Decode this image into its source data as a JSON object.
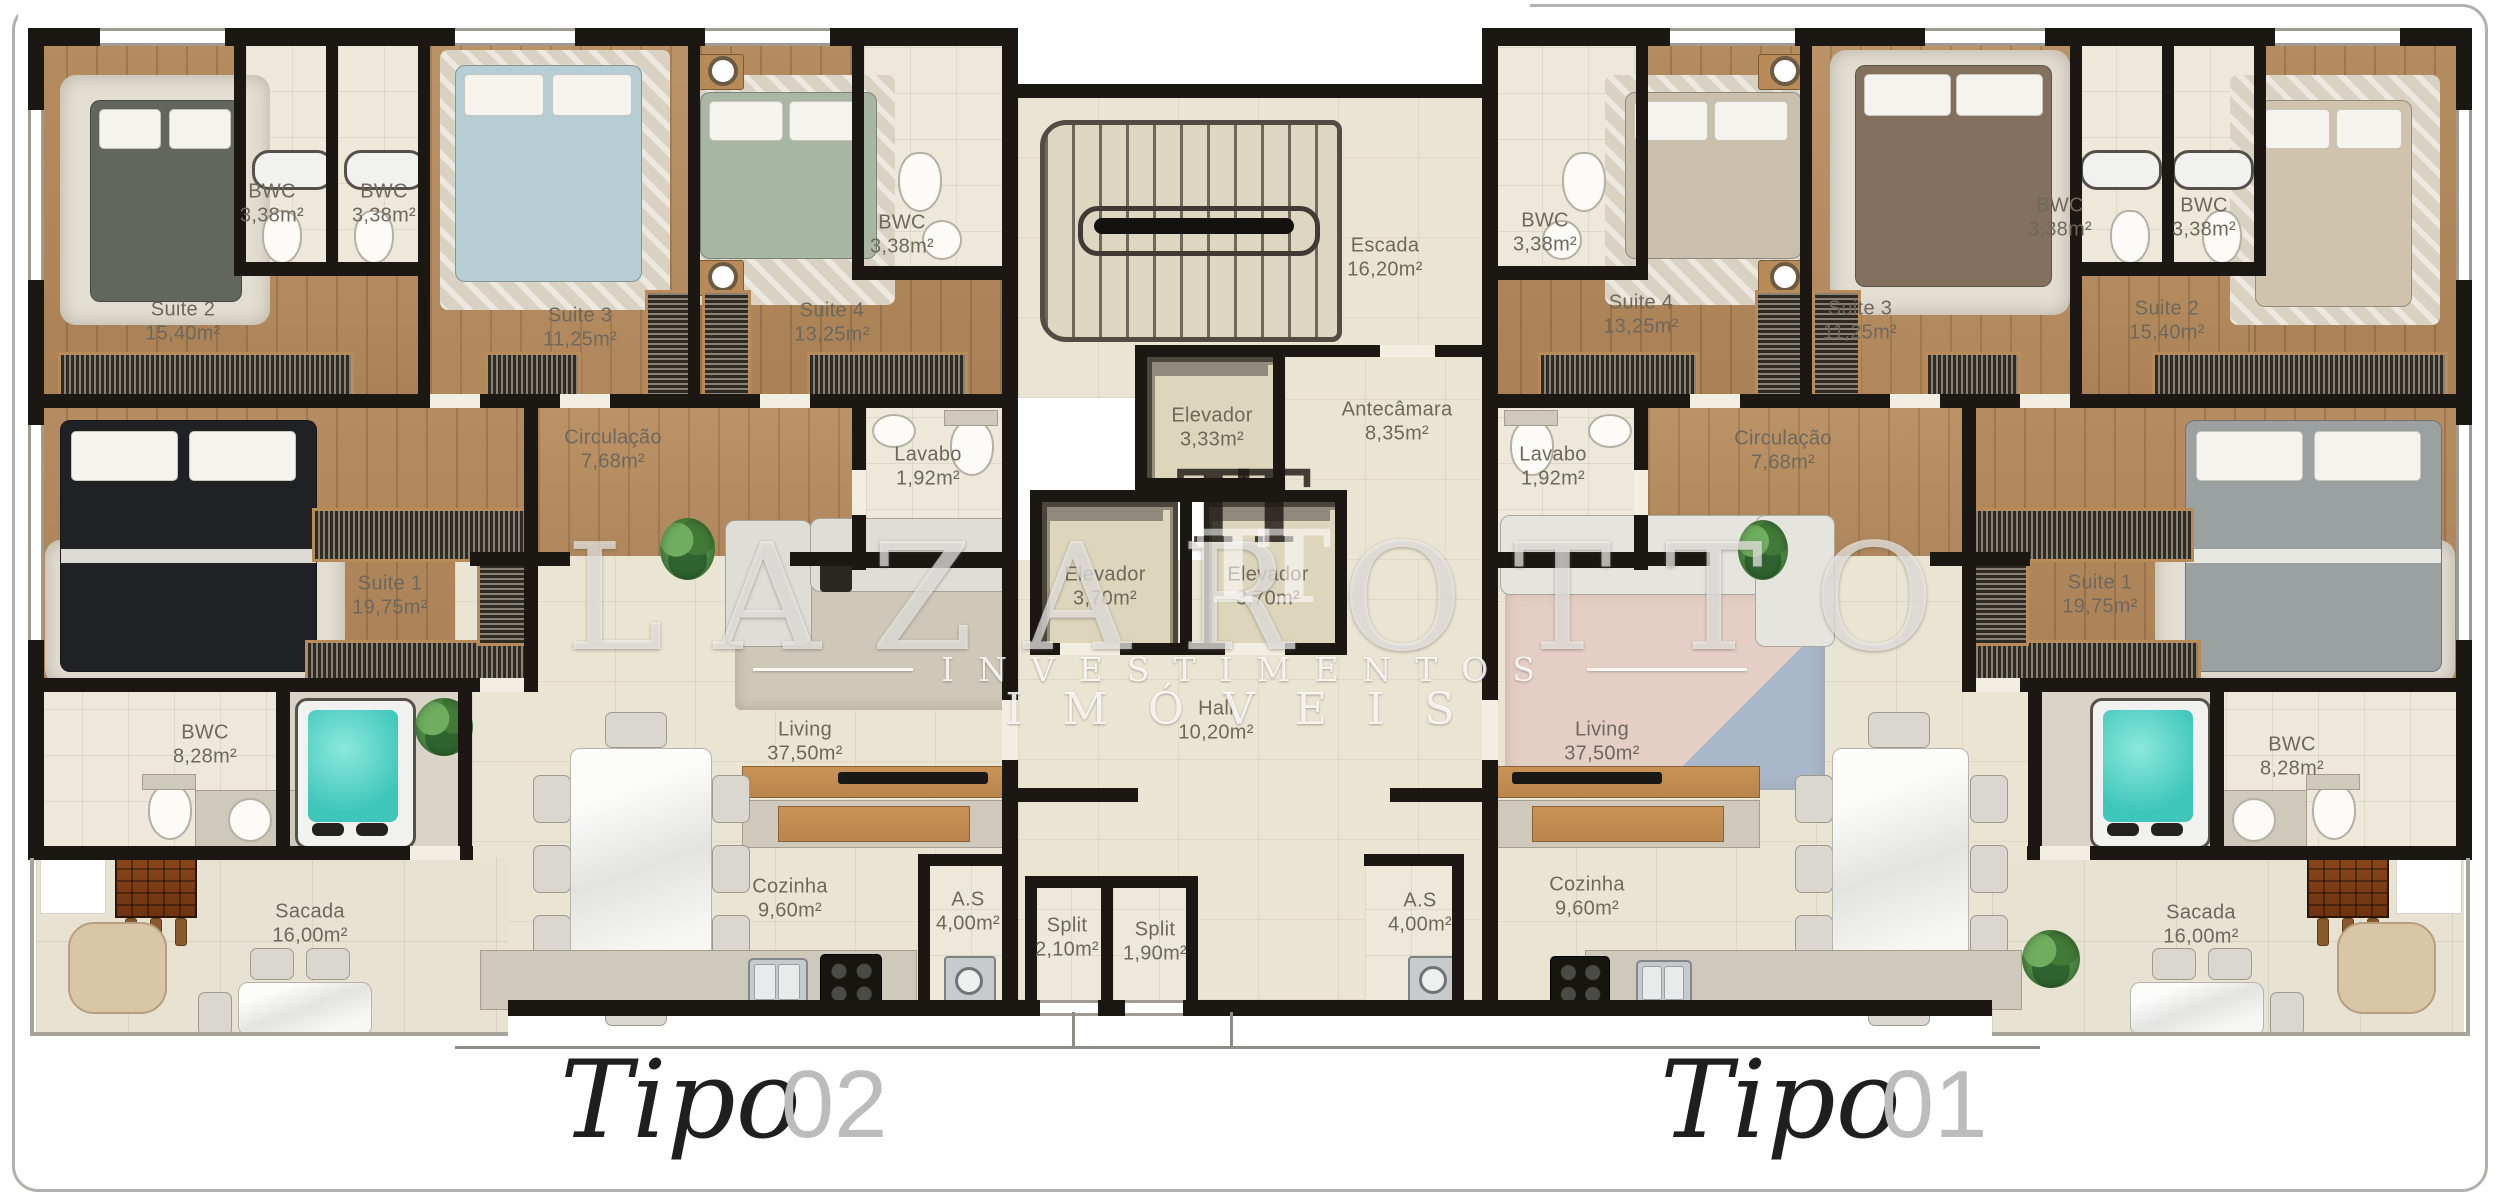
{
  "watermark": {
    "monogram": "TT",
    "brand": "LAZAROTTO",
    "line1": "INVESTIMENTOS",
    "line2": "IMÓVEIS"
  },
  "units": {
    "left": {
      "script": "Tipo",
      "number": "02"
    },
    "right": {
      "script": "Tipo",
      "number": "01"
    }
  },
  "rooms": {
    "l_suite2": {
      "name": "Suite 2",
      "area": "15,40m²"
    },
    "l_bwc_a": {
      "name": "BWC",
      "area": "3,38m²"
    },
    "l_bwc_b": {
      "name": "BWC",
      "area": "3,38m²"
    },
    "l_suite3": {
      "name": "Suite 3",
      "area": "11,25m²"
    },
    "l_suite4": {
      "name": "Suite 4",
      "area": "13,25m²"
    },
    "l_bwc_s4": {
      "name": "BWC",
      "area": "3,38m²"
    },
    "l_suite1": {
      "name": "Suite 1",
      "area": "19,75m²"
    },
    "l_circulacao": {
      "name": "Circulação",
      "area": "7,68m²"
    },
    "l_lavabo": {
      "name": "Lavabo",
      "area": "1,92m²"
    },
    "l_living": {
      "name": "Living",
      "area": "37,50m²"
    },
    "l_bwc_master": {
      "name": "BWC",
      "area": "8,28m²"
    },
    "l_sacada": {
      "name": "Sacada",
      "area": "16,00m²"
    },
    "l_cozinha": {
      "name": "Cozinha",
      "area": "9,60m²"
    },
    "l_as": {
      "name": "A.S",
      "area": "4,00m²"
    },
    "split_a": {
      "name": "Split",
      "area": "2,10m²"
    },
    "split_b": {
      "name": "Split",
      "area": "1,90m²"
    },
    "escada": {
      "name": "Escada",
      "area": "16,20m²"
    },
    "elevador_1": {
      "name": "Elevador",
      "area": "3,33m²"
    },
    "antecamara": {
      "name": "Antecâmara",
      "area": "8,35m²"
    },
    "elevador_2": {
      "name": "Elevador",
      "area": "3,70m²"
    },
    "elevador_3": {
      "name": "Elevador",
      "area": "3,70m²"
    },
    "hall": {
      "name": "Hall",
      "area": "10,20m²"
    },
    "r_bwc_s4": {
      "name": "BWC",
      "area": "3,38m²"
    },
    "r_suite4": {
      "name": "Suite 4",
      "area": "13,25m²"
    },
    "r_suite3": {
      "name": "Suite 3",
      "area": "11,25m²"
    },
    "r_bwc_a": {
      "name": "BWC",
      "area": "3,38m²"
    },
    "r_bwc_b": {
      "name": "BWC",
      "area": "3,38m²"
    },
    "r_suite2": {
      "name": "Suite 2",
      "area": "15,40m²"
    },
    "r_lavabo": {
      "name": "Lavabo",
      "area": "1,92m²"
    },
    "r_circulacao": {
      "name": "Circulação",
      "area": "7,68m²"
    },
    "r_suite1": {
      "name": "Suite 1",
      "area": "19,75m²"
    },
    "r_living": {
      "name": "Living",
      "area": "37,50m²"
    },
    "r_as": {
      "name": "A.S",
      "area": "4,00m²"
    },
    "r_cozinha": {
      "name": "Cozinha",
      "area": "9,60m²"
    },
    "r_bwc_master": {
      "name": "BWC",
      "area": "8,28m²"
    },
    "r_sacada": {
      "name": "Sacada",
      "area": "16,00m²"
    }
  }
}
